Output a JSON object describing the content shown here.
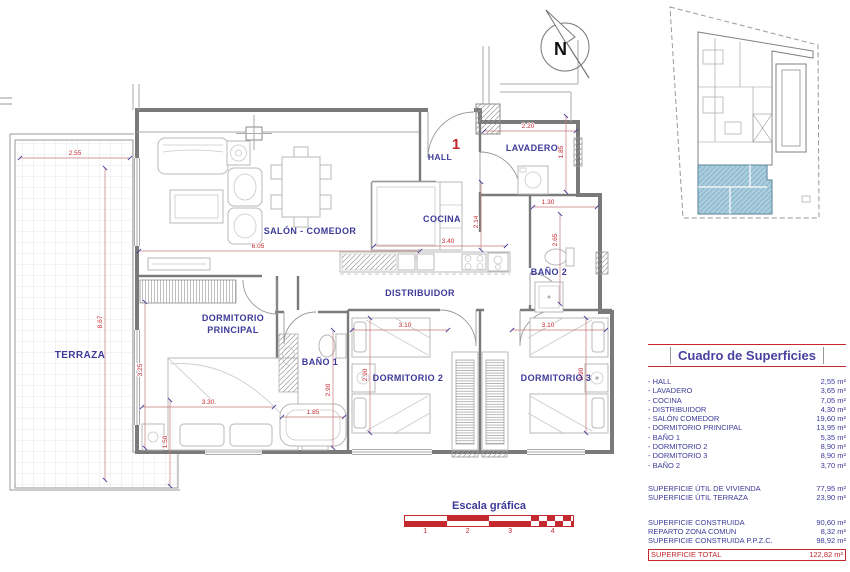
{
  "plan": {
    "unit_number": "1",
    "north_label": "N",
    "rooms": {
      "terraza": "TERRAZA",
      "salon": "SALÓN - COMEDOR",
      "cocina": "COCINA",
      "hall": "HALL",
      "lavadero": "LAVADERO",
      "distribuidor": "DISTRIBUIDOR",
      "bano2": "BAÑO 2",
      "ppal_line1": "DORMITORIO",
      "ppal_line2": "PRINCIPAL",
      "bano1": "BAÑO 1",
      "dorm2": "DORMITORIO 2",
      "dorm3": "DORMITORIO 3"
    },
    "dims": {
      "terraza_top": "2.55",
      "terraza_left": "8.67",
      "terraza_bottom": "1.50",
      "salon_w": "6.05",
      "cocina_w": "3.40",
      "cocina_h": "2.14",
      "lav_w": "2.20",
      "lav_h": "1.85",
      "bano2_w": "1.30",
      "bano2_h": "2.65",
      "ppal_h": "3.25",
      "ppal_w": "3.30",
      "bano1_w": "1.85",
      "bano1_h": "2.90",
      "dorm2_w": "3.10",
      "dorm2_h": "2.90",
      "dorm3_w": "3.10",
      "dorm3_h": "2.90"
    }
  },
  "surface_table": {
    "title": "Cuadro de Superficies",
    "rooms": [
      {
        "label": "- HALL",
        "value": "2,55 m²"
      },
      {
        "label": "- LAVADERO",
        "value": "3,65 m²"
      },
      {
        "label": "- COCINA",
        "value": "7,05 m²"
      },
      {
        "label": "- DISTRIBUIDOR",
        "value": "4,30 m²"
      },
      {
        "label": "- SALÓN COMEDOR",
        "value": "19,60 m²"
      },
      {
        "label": "- DORMITORIO PRINCIPAL",
        "value": "13,95 m²"
      },
      {
        "label": "- BAÑO 1",
        "value": "5,35 m²"
      },
      {
        "label": "- DORMITORIO 2",
        "value": "8,90 m²"
      },
      {
        "label": "- DORMITORIO 3",
        "value": "8,90 m²"
      },
      {
        "label": "- BAÑO 2",
        "value": "3,70 m²"
      }
    ],
    "useful": [
      {
        "label": "SUPERFICIE ÚTIL DE VIVIENDA",
        "value": "77,95 m²"
      },
      {
        "label": "SUPERFICIE ÚTIL TERRAZA",
        "value": "23,90 m²"
      }
    ],
    "built": [
      {
        "label": "SUPERFICIE CONSTRUIDA",
        "value": "90,60 m²"
      },
      {
        "label": "REPARTO ZONA COMUN",
        "value": "8,32 m²"
      },
      {
        "label": "SUPERFICIE CONSTRUIDA P.P.Z.C.",
        "value": "98,92 m²"
      }
    ],
    "total": {
      "label": "SUPERFICIE TOTAL",
      "value": "122,82 m²"
    }
  },
  "scale_bar": {
    "title": "Escala gráfica",
    "ticks": [
      "1",
      "2",
      "3",
      "4"
    ]
  },
  "colors": {
    "label_blue": "#3d3a99",
    "accent_red": "#c2282e",
    "wall_gray": "#7a7a7a",
    "highlight_blue": "#a9cede"
  }
}
